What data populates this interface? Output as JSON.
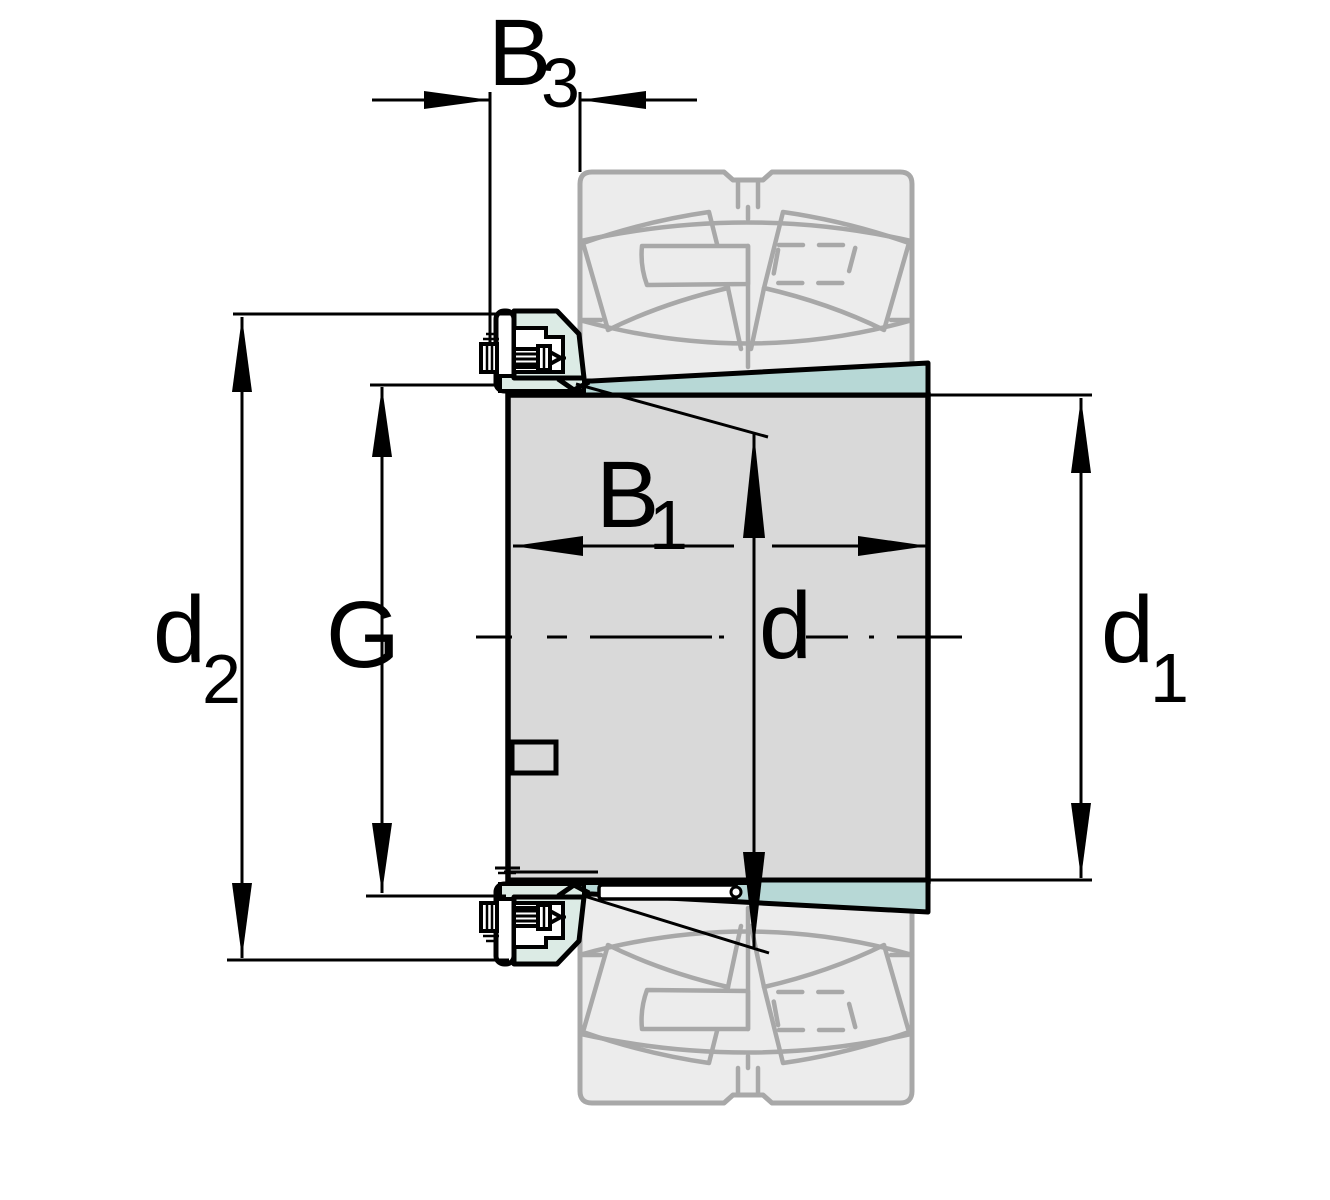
{
  "figure": {
    "type": "technical-drawing",
    "description": "Cross-section drawing of an adapter sleeve with lock nut and ghosted spherical roller bearing, with dimension annotations",
    "labels": {
      "b3": {
        "main": "B",
        "sub": "3"
      },
      "b1": {
        "main": "B",
        "sub": "1"
      },
      "d2": {
        "main": "d",
        "sub": "2"
      },
      "g": {
        "main": "G",
        "sub": ""
      },
      "d": {
        "main": "d",
        "sub": ""
      },
      "d1": {
        "main": "d",
        "sub": "1"
      }
    },
    "colors": {
      "sleeve_section": "#b7d8d6",
      "nut_section": "#dcebe5",
      "ghost_fill": "#ececec",
      "ghost_stroke": "#a8a8a8",
      "bore_fill": "#d9d9d9",
      "line": "#000000",
      "background": "#ffffff"
    }
  }
}
